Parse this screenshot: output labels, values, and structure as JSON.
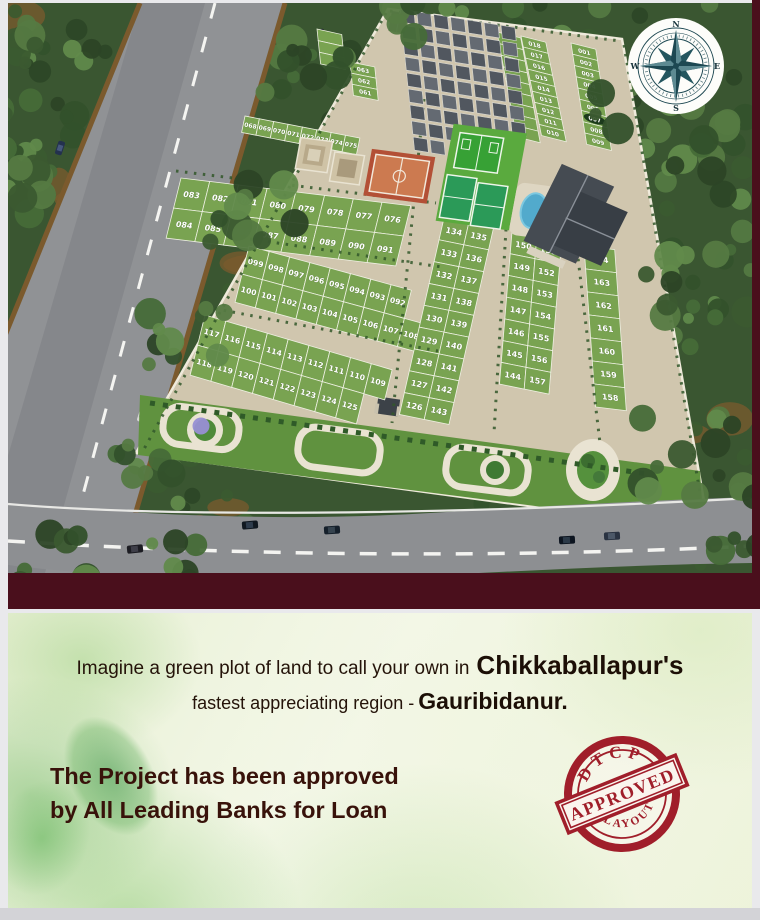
{
  "page": {
    "bg_color": "#e9e9ec",
    "divider_color": "#4a0f1c",
    "bottom_strip_color": "#d3d3d7"
  },
  "site_plan": {
    "compass": {
      "n": "N",
      "e": "E",
      "s": "S",
      "w": "W"
    },
    "highlighted_plot": "007",
    "plot_groups": [
      {
        "name": "north-col-019-027",
        "dir": "col",
        "x": 497,
        "y": 29,
        "cw": 24,
        "ch": 12,
        "bx": 0.25,
        "cx": 0.18,
        "fs": 6,
        "cols": [
          [
            "",
            "",
            "",
            "",
            "",
            "",
            "",
            "",
            ""
          ]
        ]
      },
      {
        "name": "north-col-010-018",
        "dir": "col",
        "x": 521,
        "y": 33,
        "cw": 25,
        "ch": 11.4,
        "bx": 0.25,
        "cx": 0.2,
        "fs": 6,
        "cols": [
          [
            "018",
            "017",
            "016",
            "015",
            "014",
            "013",
            "012",
            "011",
            "010"
          ]
        ]
      },
      {
        "name": "north-col-001-009",
        "dir": "col",
        "x": 571,
        "y": 40,
        "cw": 25,
        "ch": 11.6,
        "bx": 0.25,
        "cx": 0.15,
        "fs": 6,
        "highlight": "007",
        "cols": [
          [
            "001",
            "002",
            "003",
            "004",
            "005",
            "006",
            "007",
            "008",
            "009"
          ]
        ]
      },
      {
        "name": "col-061-063",
        "dir": "col",
        "x": 350,
        "y": 59,
        "cw": 25,
        "ch": 11.5,
        "bx": 0.2,
        "cx": 0.1,
        "fs": 6,
        "cols": [
          [
            "063",
            "062",
            "061"
          ]
        ]
      },
      {
        "name": "strip-west",
        "dir": "col",
        "x": 317,
        "y": 26,
        "cw": 25,
        "ch": 12,
        "bx": 0.22,
        "cx": 0.1,
        "fs": 6,
        "cols": [
          [
            "",
            "",
            ""
          ]
        ]
      },
      {
        "name": "row-068-075",
        "dir": "row",
        "x": 245,
        "y": 113,
        "cw": 14.5,
        "ch": 17,
        "bx": 0.19,
        "cx": -0.2,
        "fs": 6,
        "rows": [
          [
            "068",
            "069",
            "070",
            "071",
            "072",
            "073",
            "074",
            "075"
          ]
        ]
      },
      {
        "name": "block-076-091",
        "dir": "row",
        "x": 181,
        "y": 175,
        "cw": 29,
        "ch": 31,
        "bx": 0.12,
        "cx": -0.24,
        "fs": 8,
        "rows": [
          [
            "083",
            "082",
            "081",
            "080",
            "079",
            "078",
            "077",
            "076"
          ],
          [
            "084",
            "085",
            "086",
            "087",
            "088",
            "089",
            "090",
            "091"
          ]
        ]
      },
      {
        "name": "block-092-108",
        "dir": "row",
        "x": 249,
        "y": 243,
        "cw": 20.5,
        "ch": 29,
        "bx": 0.27,
        "cx": -0.24,
        "fs": 7.5,
        "rows": [
          [
            "099",
            "098",
            "097",
            "096",
            "095",
            "094",
            "093",
            "092"
          ],
          [
            "100",
            "101",
            "102",
            "103",
            "104",
            "105",
            "106",
            "107",
            "108"
          ]
        ]
      },
      {
        "name": "block-109-125",
        "dir": "row",
        "x": 205,
        "y": 312,
        "cw": 21,
        "ch": 31,
        "bx": 0.29,
        "cx": -0.24,
        "fs": 7.5,
        "rows": [
          [
            "117",
            "116",
            "115",
            "114",
            "113",
            "112",
            "111",
            "110",
            "109"
          ],
          [
            "118",
            "119",
            "120",
            "121",
            "122",
            "123",
            "124",
            "125"
          ]
        ]
      },
      {
        "name": "cols-126-143",
        "dir": "col",
        "x": 444,
        "y": 215,
        "cw": 25,
        "ch": 22.5,
        "bx": 0.2,
        "cx": -0.22,
        "fs": 8,
        "cols": [
          [
            "134",
            "133",
            "132",
            "131",
            "130",
            "129",
            "128",
            "127",
            "126"
          ],
          [
            "135",
            "136",
            "137",
            "138",
            "139",
            "140",
            "141",
            "142",
            "143"
          ]
        ]
      },
      {
        "name": "cols-144-157",
        "dir": "col",
        "x": 512,
        "y": 229,
        "cw": 25,
        "ch": 22.4,
        "bx": 0.2,
        "cx": -0.08,
        "fs": 8,
        "cols": [
          [
            "150",
            "149",
            "148",
            "147",
            "146",
            "145",
            "144"
          ],
          [
            "151",
            "152",
            "153",
            "154",
            "155",
            "156",
            "157"
          ]
        ]
      },
      {
        "name": "col-158-164",
        "dir": "col",
        "x": 584,
        "y": 243,
        "cw": 31,
        "ch": 23.7,
        "bx": 0.12,
        "cx": 0.07,
        "fs": 8,
        "cols": [
          [
            "164",
            "163",
            "162",
            "161",
            "160",
            "159",
            "158"
          ]
        ]
      }
    ]
  },
  "promo": {
    "headline_prefix": "Imagine a green plot of land to call your own in",
    "headline_bold": "Chikkaballapur's",
    "subline_prefix": "fastest appreciating region -",
    "subline_bold": "Gauribidanur.",
    "approval_line1": "The Project has been approved",
    "approval_line2": "by All Leading Banks for Loan"
  },
  "stamp": {
    "line1": "DTCP",
    "line2": "APPROVED",
    "line3": "LAYOUT",
    "color": "#a01e2a"
  },
  "colors": {
    "plot_green": "#79a351",
    "pavement": "#d0c6ae",
    "forest_base": "#3a5631",
    "highway_gray": "#8f9193",
    "stamp_red": "#a01e2a",
    "maroon": "#4a0f1c"
  }
}
